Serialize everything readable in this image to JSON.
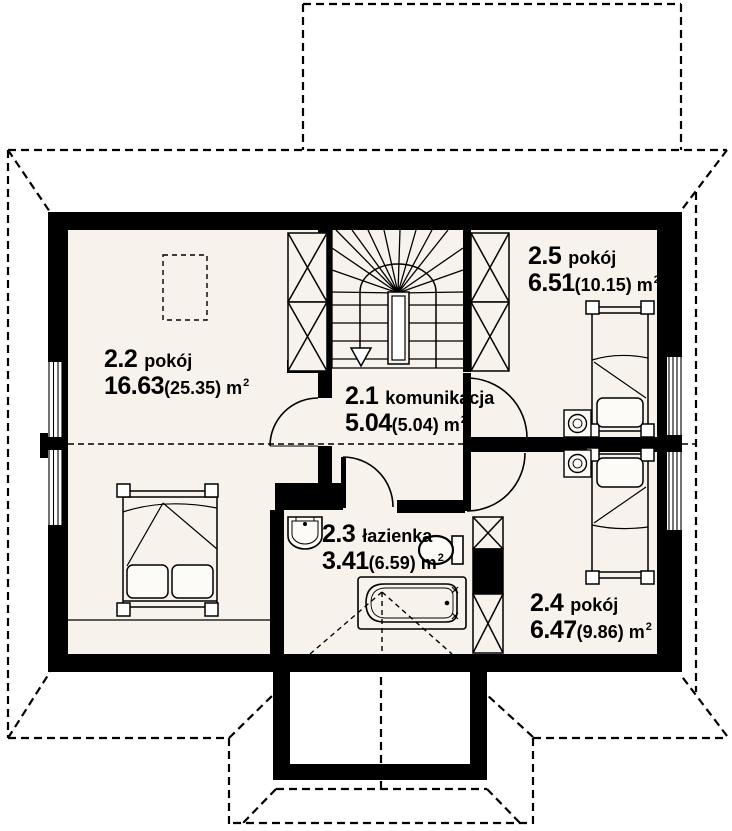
{
  "plan": {
    "type": "attic-floor-plan",
    "rooms": [
      {
        "number": "2.1",
        "name": "komunikacja",
        "area": "5.04",
        "area_secondary": "(5.04)",
        "unit": "m",
        "unit_sup": "2"
      },
      {
        "number": "2.2",
        "name": "pokój",
        "area": "16.63",
        "area_secondary": "(25.35)",
        "unit": "m",
        "unit_sup": "2"
      },
      {
        "number": "2.3",
        "name": "łazienka",
        "area": "3.41",
        "area_secondary": "(6.59)",
        "unit": "m",
        "unit_sup": "2"
      },
      {
        "number": "2.4",
        "name": "pokój",
        "area": "6.47",
        "area_secondary": "(9.86)",
        "unit": "m",
        "unit_sup": "2"
      },
      {
        "number": "2.5",
        "name": "pokój",
        "area": "6.51",
        "area_secondary": "(10.15)",
        "unit": "m",
        "unit_sup": "2"
      }
    ],
    "colors": {
      "background": "#ffffff",
      "floor": "#f7f2ec",
      "line": "#000000",
      "wall": "#000000"
    }
  }
}
